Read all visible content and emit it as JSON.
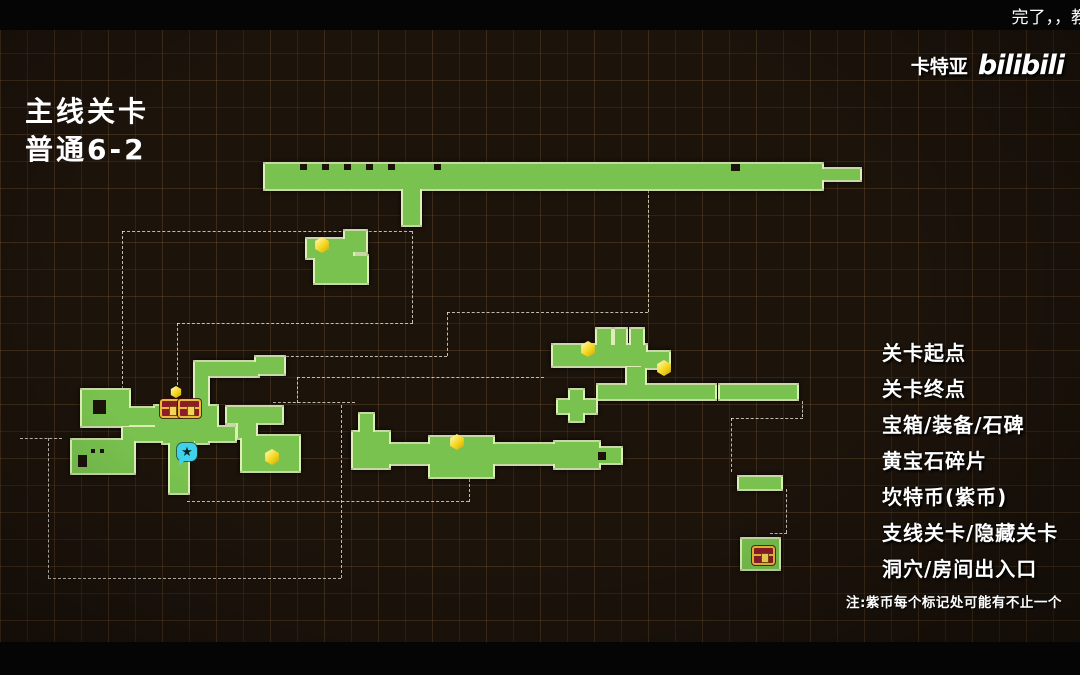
{
  "overlay": {
    "danmaku": "完了，，教",
    "watermark_name": "卡特亚",
    "watermark_logo": "bilibili"
  },
  "title": {
    "line1": "主线关卡",
    "line2": "普通6-2"
  },
  "legend": {
    "items": [
      {
        "icon": "start-pin-icon",
        "label": "关卡起点"
      },
      {
        "icon": "end-ring-icon",
        "label": "关卡终点"
      },
      {
        "icon": "chest-icon",
        "label": "宝箱/装备/石碑"
      },
      {
        "icon": "gem-icon",
        "label": "黄宝石碎片"
      },
      {
        "icon": "purple-star-icon",
        "label": "坎特币(紫币)"
      },
      {
        "icon": "hidden-level-icon",
        "label": "支线关卡/隐藏关卡"
      },
      {
        "icon": "door-icon",
        "label": "洞穴/房间出入口"
      }
    ],
    "note": "注:紫币每个标记处可能有不止一个"
  },
  "map": {
    "area_labels": [
      {
        "text": "桌面",
        "x": 517,
        "y": 210,
        "size": 21
      },
      {
        "text": "老鼠洞",
        "x": 464,
        "y": 386,
        "size": 21
      },
      {
        "text": "旅馆地板",
        "x": 134,
        "y": 518,
        "size": 22
      },
      {
        "text": "地牢",
        "x": 685,
        "y": 510,
        "size": 21
      }
    ],
    "platforms": [
      [
        265,
        164,
        557,
        25
      ],
      [
        822,
        169,
        38,
        11
      ],
      [
        403,
        187,
        17,
        38
      ],
      [
        307,
        239,
        46,
        19
      ],
      [
        345,
        231,
        21,
        21
      ],
      [
        315,
        256,
        52,
        27
      ],
      [
        553,
        345,
        93,
        21
      ],
      [
        597,
        329,
        14,
        20
      ],
      [
        615,
        329,
        11,
        18
      ],
      [
        631,
        329,
        12,
        18
      ],
      [
        641,
        352,
        28,
        16
      ],
      [
        627,
        367,
        18,
        22
      ],
      [
        598,
        385,
        117,
        14
      ],
      [
        720,
        385,
        77,
        14
      ],
      [
        570,
        390,
        13,
        31
      ],
      [
        558,
        400,
        38,
        13
      ],
      [
        360,
        414,
        13,
        19
      ],
      [
        353,
        432,
        36,
        36
      ],
      [
        374,
        444,
        185,
        20
      ],
      [
        430,
        437,
        63,
        40
      ],
      [
        555,
        442,
        44,
        26
      ],
      [
        598,
        448,
        23,
        15
      ],
      [
        256,
        357,
        28,
        17
      ],
      [
        195,
        362,
        63,
        14
      ],
      [
        195,
        362,
        13,
        81
      ],
      [
        82,
        390,
        47,
        36
      ],
      [
        128,
        408,
        30,
        17
      ],
      [
        155,
        406,
        62,
        21
      ],
      [
        163,
        415,
        31,
        28
      ],
      [
        123,
        427,
        112,
        14
      ],
      [
        72,
        440,
        62,
        33
      ],
      [
        170,
        441,
        18,
        52
      ],
      [
        227,
        407,
        55,
        16
      ],
      [
        238,
        418,
        18,
        20
      ],
      [
        242,
        436,
        57,
        35
      ],
      [
        739,
        477,
        42,
        12
      ],
      [
        742,
        539,
        37,
        30
      ]
    ],
    "notches": [
      [
        300,
        164,
        7,
        6
      ],
      [
        322,
        164,
        7,
        6
      ],
      [
        344,
        164,
        7,
        6
      ],
      [
        366,
        164,
        7,
        6
      ],
      [
        388,
        164,
        7,
        6
      ],
      [
        434,
        164,
        7,
        6
      ],
      [
        731,
        164,
        9,
        7
      ],
      [
        93,
        400,
        13,
        14
      ],
      [
        78,
        455,
        9,
        12
      ],
      [
        598,
        452,
        8,
        8
      ],
      [
        91,
        449,
        4,
        4
      ],
      [
        100,
        449,
        4,
        4
      ]
    ],
    "doors": [
      [
        405,
        221
      ],
      [
        641,
        176
      ],
      [
        347,
        231
      ],
      [
        263,
        346
      ],
      [
        253,
        395
      ],
      [
        168,
        417
      ],
      [
        61,
        430
      ],
      [
        110,
        433
      ],
      [
        168,
        490
      ],
      [
        355,
        397
      ],
      [
        544,
        369
      ],
      [
        458,
        446
      ],
      [
        792,
        382
      ],
      [
        722,
        469
      ],
      [
        775,
        469
      ],
      [
        751,
        525
      ]
    ],
    "stars": [
      [
        280,
        176,
        24
      ],
      [
        355,
        176,
        24
      ],
      [
        423,
        175,
        24
      ],
      [
        495,
        175,
        24
      ],
      [
        563,
        175,
        24
      ],
      [
        628,
        176,
        24
      ],
      [
        695,
        177,
        24
      ],
      [
        748,
        177,
        24
      ],
      [
        803,
        177,
        24
      ],
      [
        338,
        245,
        21
      ],
      [
        217,
        366,
        21
      ],
      [
        115,
        407,
        21
      ],
      [
        89,
        413,
        21
      ],
      [
        152,
        432,
        21
      ],
      [
        197,
        431,
        21
      ],
      [
        235,
        429,
        21
      ],
      [
        287,
        438,
        21
      ],
      [
        289,
        468,
        21
      ],
      [
        92,
        459,
        21
      ],
      [
        177,
        470,
        21
      ],
      [
        617,
        357,
        21
      ],
      [
        650,
        349,
        21
      ],
      [
        636,
        381,
        21
      ],
      [
        566,
        400,
        21
      ],
      [
        590,
        400,
        21
      ],
      [
        565,
        417,
        21
      ],
      [
        590,
        418,
        21
      ],
      [
        740,
        391,
        21
      ],
      [
        425,
        458,
        21
      ],
      [
        497,
        458,
        21
      ]
    ],
    "gems": [
      [
        322,
        245,
        16
      ],
      [
        588,
        349,
        16
      ],
      [
        664,
        368,
        16
      ],
      [
        457,
        442,
        16
      ],
      [
        272,
        457,
        16
      ]
    ],
    "chests": [
      [
        160,
        399,
        19,
        15
      ],
      [
        178,
        399,
        19,
        15
      ],
      [
        752,
        546,
        19,
        15
      ]
    ],
    "gold_items": [
      [
        176,
        392
      ]
    ],
    "flowers": [
      [
        187,
        452
      ]
    ],
    "slots": [
      [
        283,
        447,
        11,
        17
      ]
    ],
    "start_pin": {
      "x": 247,
      "y": 163
    },
    "end_ring": {
      "x": 857,
      "y": 164
    },
    "dashes": {
      "h": [
        [
          122,
          231,
          290
        ],
        [
          177,
          323,
          236
        ],
        [
          281,
          356,
          166
        ],
        [
          447,
          312,
          201
        ],
        [
          297,
          377,
          247
        ],
        [
          273,
          402,
          82
        ],
        [
          20,
          438,
          42
        ],
        [
          48,
          578,
          293
        ],
        [
          187,
          501,
          282
        ],
        [
          731,
          418,
          72
        ],
        [
          770,
          533,
          17
        ]
      ],
      "v": [
        [
          122,
          231,
          158
        ],
        [
          412,
          231,
          92
        ],
        [
          177,
          323,
          67
        ],
        [
          648,
          190,
          122
        ],
        [
          447,
          312,
          44
        ],
        [
          297,
          377,
          26
        ],
        [
          48,
          438,
          140
        ],
        [
          341,
          405,
          173
        ],
        [
          469,
          464,
          38
        ],
        [
          802,
          401,
          16
        ],
        [
          731,
          418,
          54
        ],
        [
          786,
          489,
          44
        ]
      ]
    }
  },
  "colors": {
    "background": "#1c130b",
    "platform_green": "#79c24f",
    "platform_edge": "#def0b6",
    "star_purple": "#b44fd8",
    "gem_yellow": "#f5d61e",
    "start_red": "#e02330",
    "end_orange": "#ef9d1f",
    "chest_red": "#8c1d28",
    "chest_gold": "#e8bb37",
    "hidden_cyan": "#3fd2ea",
    "door_border": "#f2f2ee"
  }
}
